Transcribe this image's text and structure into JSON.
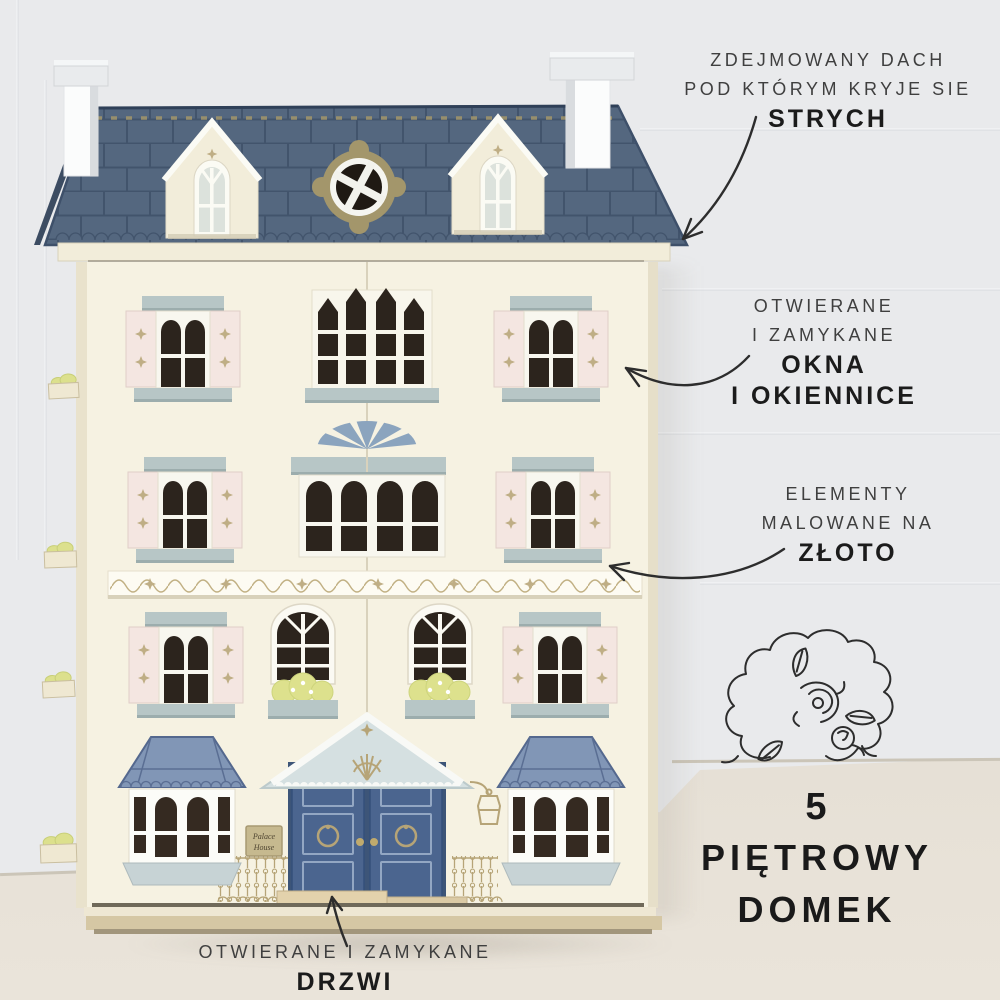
{
  "callouts": {
    "roof": {
      "lines": [
        "ZDEJMOWANY DACH",
        "POD KTÓRYM KRYJE SIE"
      ],
      "emphasis": [
        "STRYCH"
      ]
    },
    "windows": {
      "lines": [
        "OTWIERANE",
        "I ZAMYKANE"
      ],
      "emphasis": [
        "OKNA",
        "I OKIENNICE"
      ]
    },
    "gold": {
      "lines": [
        "ELEMENTY",
        "MALOWANE NA"
      ],
      "emphasis": [
        "ZŁOTO"
      ]
    },
    "floors": {
      "number": "5",
      "lines": [
        "PIĘTROWY",
        "DOMEK"
      ]
    },
    "door": {
      "lines": [
        "OTWIERANE I ZAMYKANE"
      ],
      "emphasis": [
        "DRZWI"
      ]
    }
  },
  "house": {
    "plaque": {
      "line1": "Palace",
      "line2": "House"
    }
  },
  "palette": {
    "wall": "#e9eaec",
    "floor": "#e2dcd2",
    "roof_blue": "#54677f",
    "roof_line": "#42546c",
    "bay_roof_blue": "#8196b6",
    "door_blue": "#4b658f",
    "cream": "#f6f2e2",
    "shutter_pink": "#f4e6e1",
    "trim_blue_gray": "#b7c6c6",
    "gold": "#b6a477",
    "leaf_green": "#dce08d",
    "text_dark": "#2d2d2d"
  }
}
